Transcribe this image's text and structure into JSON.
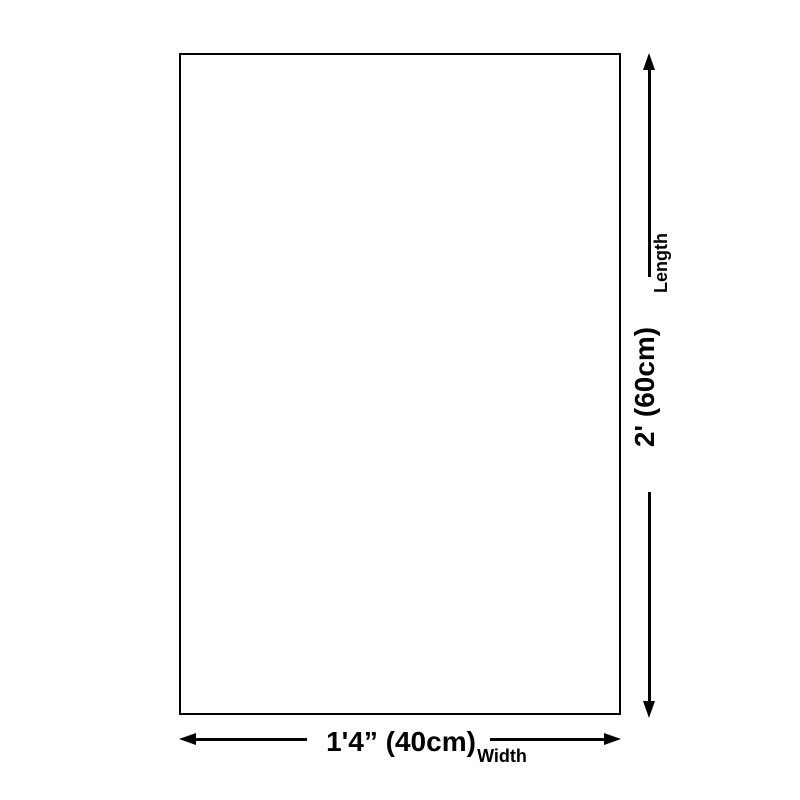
{
  "diagram": {
    "background_color": "#ffffff",
    "line_color": "#000000",
    "rectangle": {
      "fill_color": "#ffffff",
      "border_color": "#000000"
    },
    "length_dimension": {
      "value": "2' (60cm)",
      "label": "Length"
    },
    "width_dimension": {
      "value": "1'4” (40cm)",
      "label": "Width"
    }
  }
}
